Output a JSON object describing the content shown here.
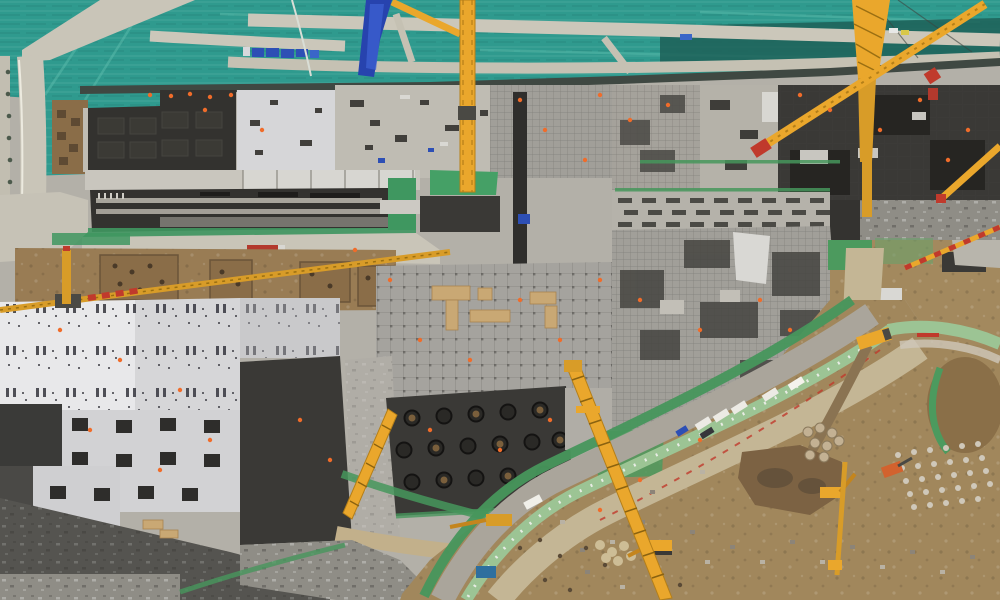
{
  "meta": {
    "title": "Aerial view of a large construction site",
    "image_type": "aerial drone photograph",
    "width_px": 1000,
    "height_px": 600
  },
  "palette": {
    "base": "#b3b0a8",
    "teal": "#2f9a8e",
    "tealShadow": "#1d6058",
    "road": "#c9c5b8",
    "pavement": "#c6c2b6",
    "wall": "#3f4842",
    "blockDark": "#33322f",
    "formwork": "#3a3936",
    "deepBlack": "#262522",
    "slabWhite": "#e8e8ea",
    "slabGray": "#d6d6d8",
    "slabLight": "#bfbcb3",
    "mesh": "#a19f99",
    "gridSlab": "#a5a39e",
    "corridor": "#b5b2aa",
    "dirt": "#997c54",
    "dirtDeep": "#8a6d48",
    "haulDirt": "#a1875c",
    "sandRoad": "#c4b695",
    "mint": "#9cc494",
    "greenNet": "#3f9760",
    "grass": "#4c9a5e",
    "craneYellow": "#eaa72c",
    "craneDeep": "#d89c28",
    "red": "#c03a2c",
    "blue": "#2d4fb5",
    "blueTarp": "#2743ae",
    "orange": "#f06c2a",
    "wood": "#c9a874",
    "mud": "#7c6243",
    "mudDark": "#62503a",
    "gravel": "#cfc8ba",
    "rubble": "#8f8d86",
    "white": "#eceae4",
    "truckGray": "#aaa59b"
  },
  "scene": {
    "description": "Top band: teal dust-control netting crossed by light access roads, a blue tarp strip and a row of blue trucks. Center: concrete foundation slabs, black formwork blocks, a long striped podium structure, dense rebar mats with timber platforms and scattered workers in orange. Left: white column slab buildings; bottom-center: dark pile-cap slab with circular pile heads. Bottom right: diagonal haul road corridor with green safety netting, trucks, excavators, mud pond, gravel stockpiles and a netted spoil mound. Several yellow tower cranes and booms span the site.",
    "areas": [
      {
        "id": "dust-netting",
        "label": "Teal dust-control netting"
      },
      {
        "id": "netting-roads",
        "label": "Access roads over netting"
      },
      {
        "id": "blue-tarp-strip",
        "label": "Blue tarp strip"
      },
      {
        "id": "retaining-wall",
        "label": "Dark pit edge wall"
      },
      {
        "id": "formwork-block",
        "label": "Black formwork block"
      },
      {
        "id": "striped-podium",
        "label": "Long striped podium structure"
      },
      {
        "id": "rebar-mats",
        "label": "Rebar mat zones"
      },
      {
        "id": "timber-platforms",
        "label": "Timber work platforms"
      },
      {
        "id": "white-column-slab",
        "label": "White column slab building"
      },
      {
        "id": "pile-cap-slab",
        "label": "Pile-cap slab with circular pile heads"
      },
      {
        "id": "foundation-pits",
        "label": "Excavated foundation pits"
      },
      {
        "id": "haul-road",
        "label": "Diagonal haul road corridor"
      },
      {
        "id": "green-safety-net",
        "label": "Green safety netting strips"
      },
      {
        "id": "mud-pond",
        "label": "Mud pond"
      },
      {
        "id": "spoil-mound",
        "label": "Netted spoil mound"
      },
      {
        "id": "gravel-stockpiles",
        "label": "Gravel stockpile rows"
      },
      {
        "id": "tower-cranes",
        "label": "Yellow tower cranes"
      },
      {
        "id": "vehicles",
        "label": "Trucks, vans and excavators"
      }
    ],
    "equipment": {
      "tower_crane_masts": 6,
      "crane_booms": 4,
      "excavators": 4,
      "trucks_and_vans": 13
    },
    "markers": {
      "workers": "scattered orange safety-vest dots",
      "safety_netting_color": "#3f9760"
    }
  }
}
